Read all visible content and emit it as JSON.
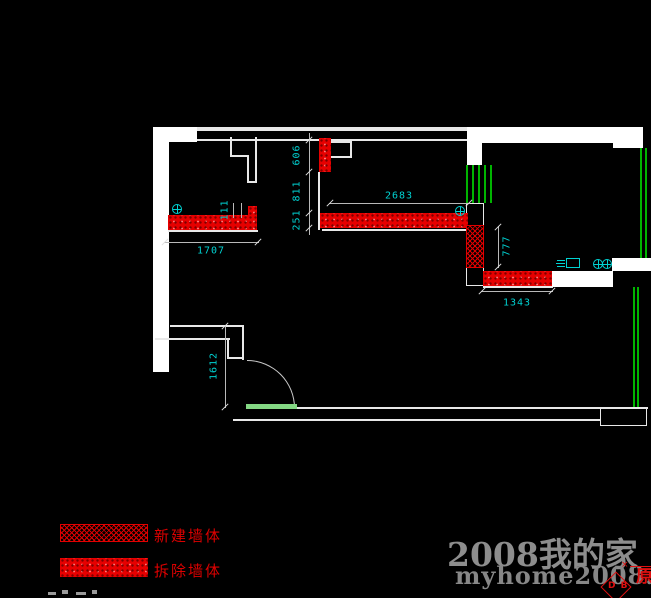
{
  "colors": {
    "background": "#000000",
    "wall": "#ffffff",
    "demolish_wall": "#e60000",
    "new_wall": "#e00000",
    "dimension_text": "#00d2d2",
    "window": "#00b400",
    "door_leaf": "#84d884",
    "legend_text": "#dd0000",
    "watermark": "#8d8d8d",
    "stamp": "#e01010"
  },
  "dimensions": {
    "top_wall_upper": "606",
    "top_wall_middle": "811",
    "top_wall_lower": "251",
    "kitchen_wall": "2683",
    "left_wall_notch": "111",
    "left_wall": "1707",
    "new_wall_height": "777",
    "lower_wall": "1343",
    "entry_wall": "1612"
  },
  "legend": {
    "new_wall_label": "新建墙体",
    "demolish_wall_label": "拆除墙体"
  },
  "watermark": {
    "site_name": "2008我的家",
    "site_url": "myhome2008.com"
  },
  "stamp": {
    "letters": "D B",
    "character": "原",
    "cross_mark": "×"
  }
}
